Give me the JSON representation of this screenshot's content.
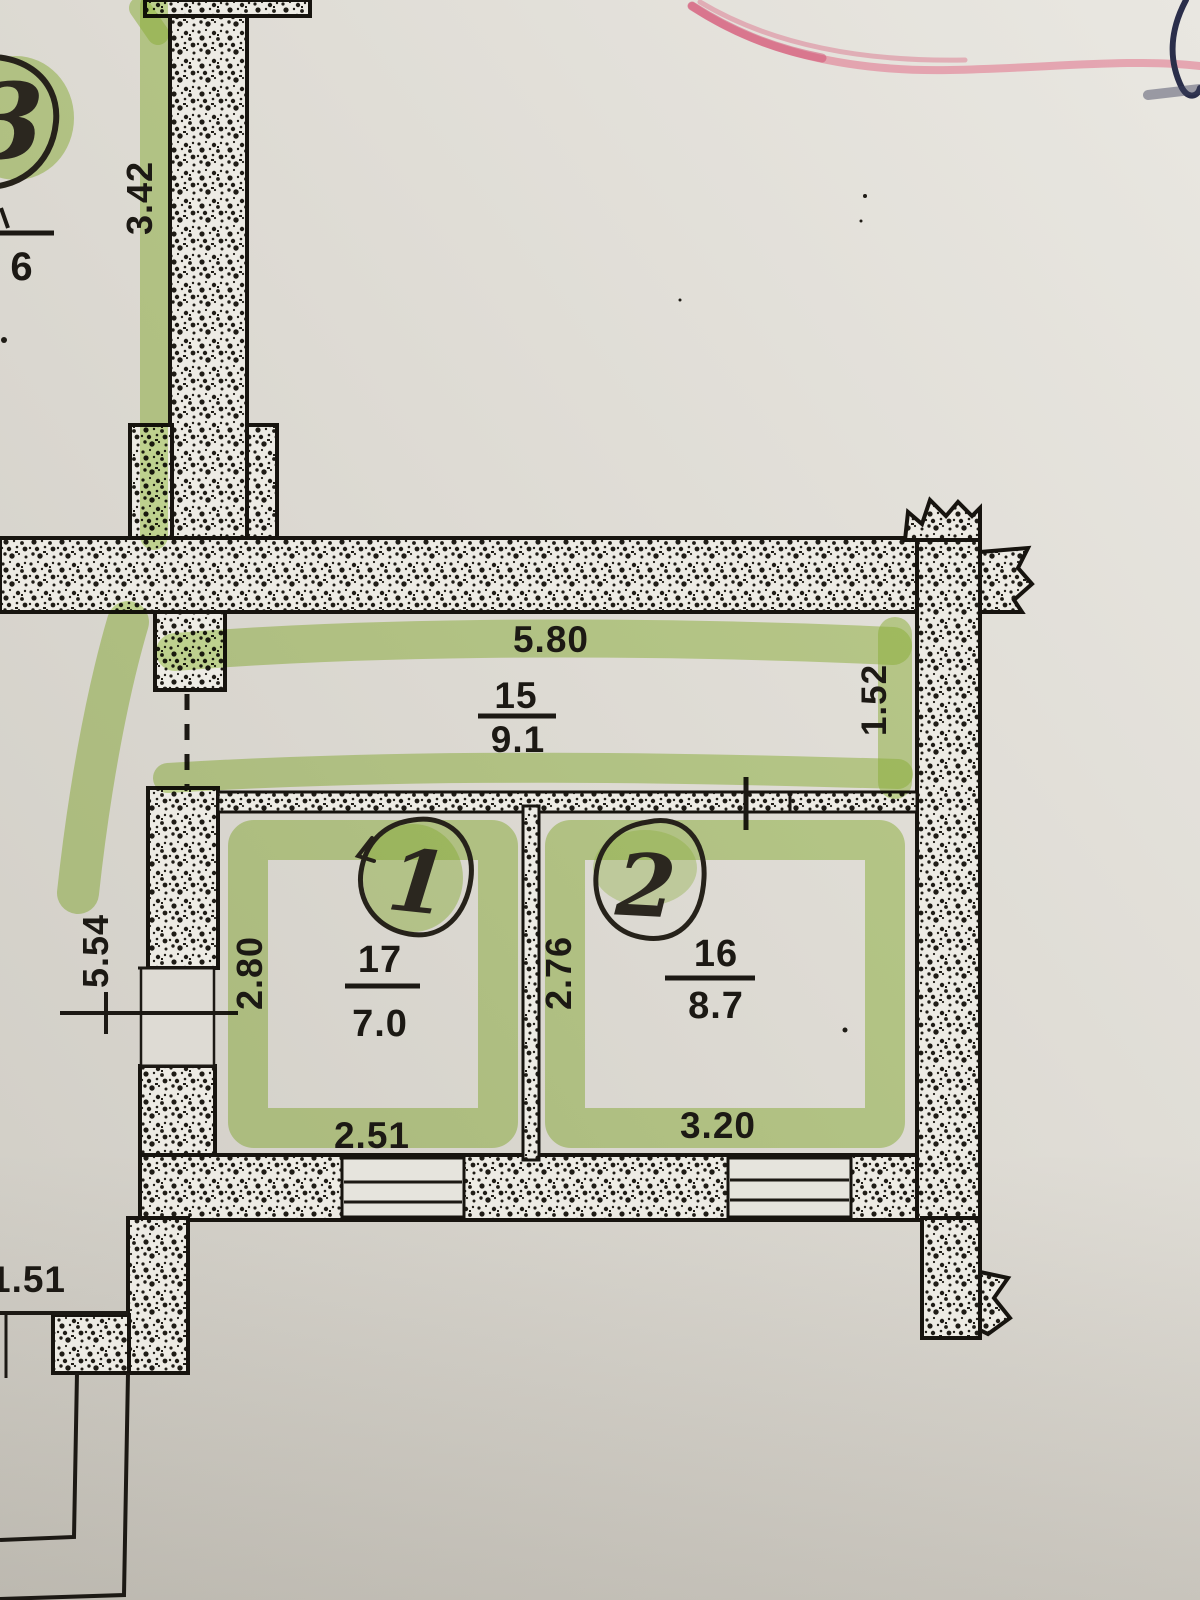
{
  "floor_plan": {
    "corridor": {
      "number": "15",
      "area": "9.1",
      "width_dim": "5.80",
      "depth_dim": "1.52"
    },
    "room_left": {
      "number": "17",
      "area": "7.0",
      "width_dim": "2.51",
      "depth_dim": "2.80",
      "handwritten_mark": "1"
    },
    "room_right": {
      "number": "16",
      "area": "8.7",
      "width_dim": "3.20",
      "depth_dim": "2.76",
      "handwritten_mark": "2"
    },
    "adjacent": {
      "wall_dim": "3.42",
      "left_dim": "5.54",
      "bottom_dim": "1.51",
      "partial_area": "6",
      "handwritten_mark": "3"
    }
  },
  "annotations": {
    "highlighter_color": "#9cc83f",
    "pink_stroke_color": "#e2718a",
    "pen_stroke_color": "#2a2e4a"
  }
}
